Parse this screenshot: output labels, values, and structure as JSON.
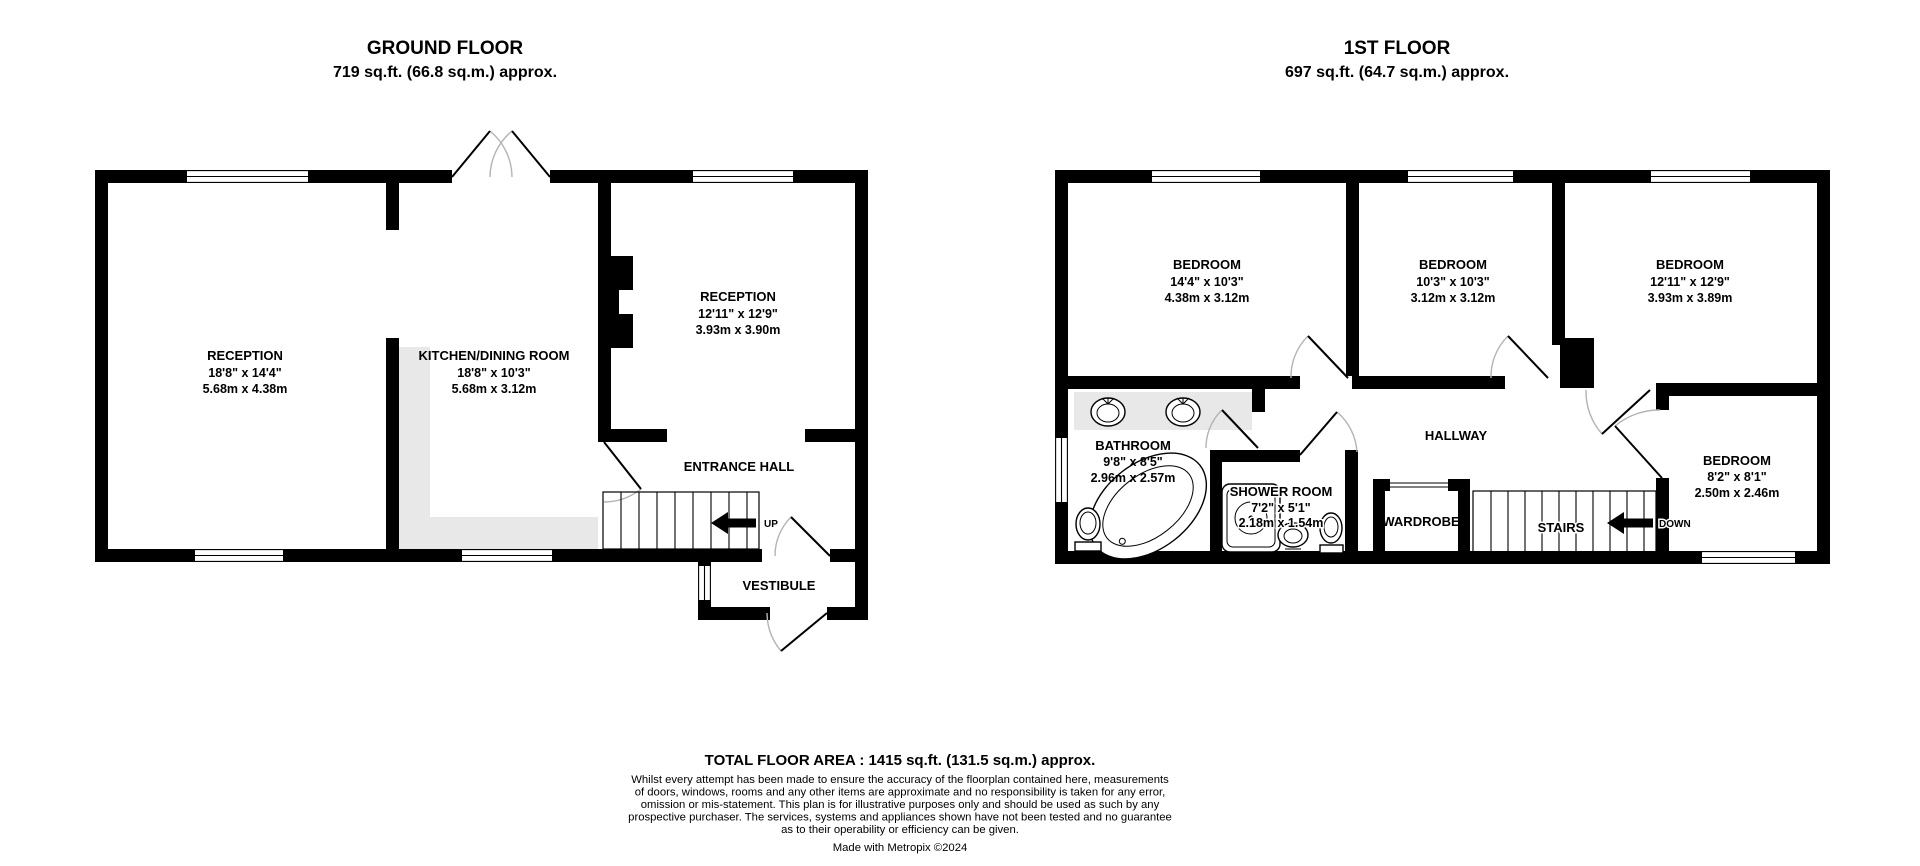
{
  "floors": {
    "ground": {
      "title": "GROUND FLOOR",
      "subtitle": "719 sq.ft. (66.8 sq.m.) approx.",
      "rooms": {
        "reception_left": {
          "name": "RECEPTION",
          "imperial": "18'8\" x 14'4\"",
          "metric": "5.68m x 4.38m"
        },
        "kitchen": {
          "name": "KITCHEN/DINING ROOM",
          "imperial": "18'8\" x 10'3\"",
          "metric": "5.68m x 3.12m"
        },
        "reception_right": {
          "name": "RECEPTION",
          "imperial": "12'11\" x 12'9\"",
          "metric": "3.93m x 3.90m"
        },
        "entrance_hall": {
          "name": "ENTRANCE HALL"
        },
        "vestibule": {
          "name": "VESTIBULE"
        }
      },
      "stairs_direction": "UP"
    },
    "first": {
      "title": "1ST FLOOR",
      "subtitle": "697 sq.ft. (64.7 sq.m.) approx.",
      "rooms": {
        "bedroom1": {
          "name": "BEDROOM",
          "imperial": "14'4\" x 10'3\"",
          "metric": "4.38m x 3.12m"
        },
        "bedroom2": {
          "name": "BEDROOM",
          "imperial": "10'3\" x 10'3\"",
          "metric": "3.12m x 3.12m"
        },
        "bedroom3": {
          "name": "BEDROOM",
          "imperial": "12'11\" x 12'9\"",
          "metric": "3.93m x 3.89m"
        },
        "bedroom4": {
          "name": "BEDROOM",
          "imperial": "8'2\" x 8'1\"",
          "metric": "2.50m x 2.46m"
        },
        "bathroom": {
          "name": "BATHROOM",
          "imperial": "9'8\" x 8'5\"",
          "metric": "2.96m x 2.57m"
        },
        "shower_room": {
          "name": "SHOWER ROOM",
          "imperial": "7'2\" x 5'1\"",
          "metric": "2.18m x 1.54m"
        },
        "hallway": {
          "name": "HALLWAY"
        },
        "wardrobe": {
          "name": "WARDROBE"
        }
      },
      "stairs_label": "STAIRS",
      "stairs_direction": "DOWN"
    }
  },
  "footer": {
    "total_area": "TOTAL FLOOR AREA : 1415 sq.ft. (131.5 sq.m.) approx.",
    "disclaimer_lines": [
      "Whilst every attempt has been made to ensure the accuracy of the floorplan contained here, measurements",
      "of doors, windows, rooms and any other items are approximate and no responsibility is taken for any error,",
      "omission or mis-statement. This plan is for illustrative purposes only and should be used as such by any",
      "prospective purchaser. The services, systems and appliances shown have not been tested and no guarantee",
      "as to their operability or efficiency can be given."
    ],
    "credit": "Made with Metropix ©2024"
  },
  "colors": {
    "wall": "#000000",
    "shading": "#e8e8e8",
    "door_arc": "#b3b3b3"
  }
}
